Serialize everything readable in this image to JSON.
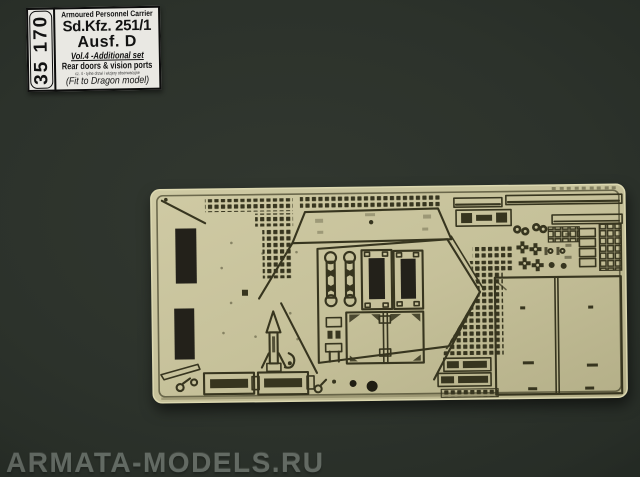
{
  "scene": {
    "description": "Product photo of a photo-etched brass detail fret for a 1:35 scale model on a dark green background"
  },
  "label": {
    "set_number": "35 170",
    "title_small": "Armoured Personnel Carrier",
    "title_main": "Sd.Kfz. 251/1",
    "title_sub": "Ausf. D",
    "volume_line": "Vol.4 -Additional set",
    "contents_line": "Rear doors & vision ports",
    "contents_line_small": "cz. 4 - tylne drzwi i wizjery obserwacyjne",
    "fit_line": "(Fit to Dragon model)"
  },
  "watermark": {
    "text": "ARMATA-MODELS.RU"
  },
  "colors": {
    "background": "#2c322b",
    "brass": "#c6c19a",
    "brass_light": "#dcd8b0",
    "brass_dark": "#b2ad86",
    "etch": "#37351f",
    "cutout": "#23211a",
    "label_paper": "#e9e8e3",
    "label_text": "#121212",
    "watermark": "#79817a"
  }
}
